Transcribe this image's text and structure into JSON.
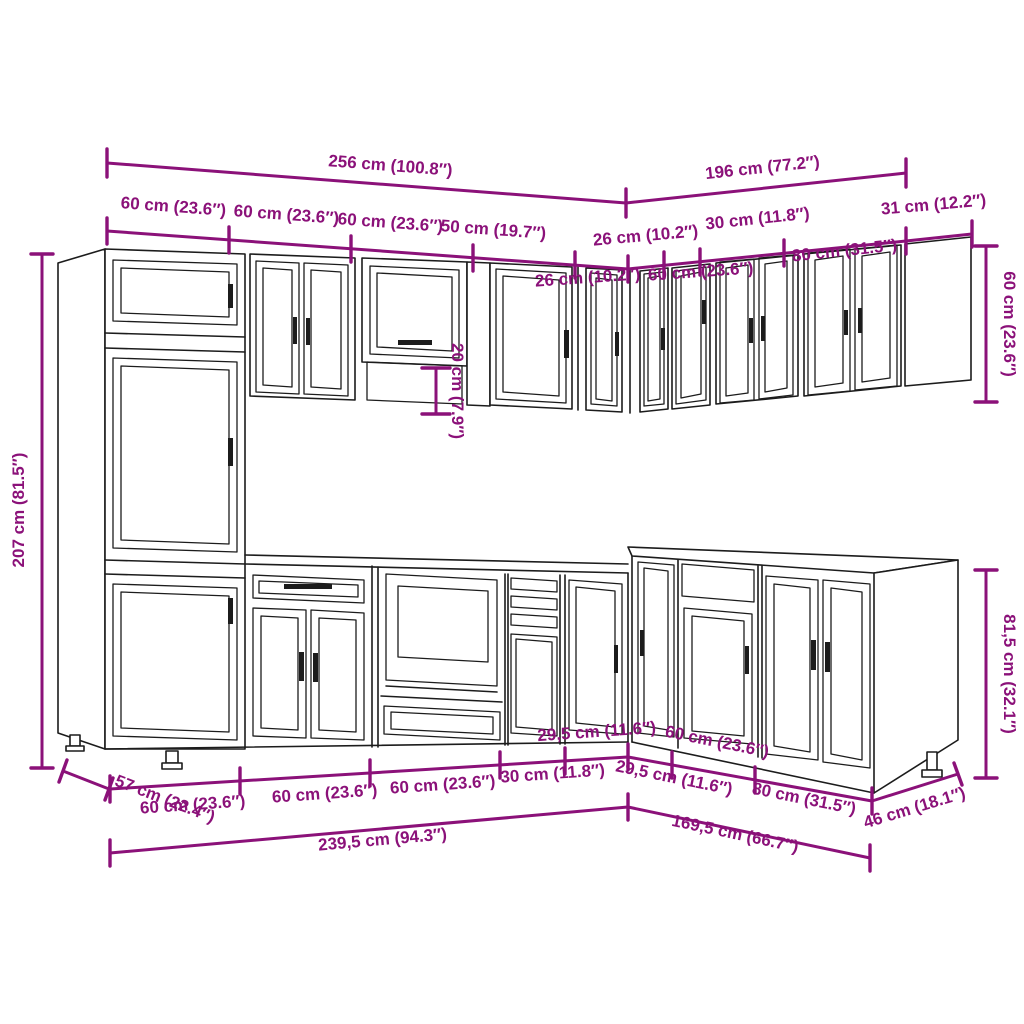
{
  "title": "L-shaped kitchen cabinet set dimension diagram",
  "colors": {
    "dimension": "#8B1179",
    "outline": "#1c1c1c",
    "background": "#ffffff"
  },
  "labels": {
    "top_total_left": "256 cm (100.8″)",
    "top_total_right": "196 cm (77.2″)",
    "wall_left": [
      "60 cm (23.6″)",
      "60 cm (23.6″)",
      "60 cm (23.6″)",
      "50 cm (19.7″)",
      "26 cm (10.2″)"
    ],
    "wall_right": [
      "26 cm (10.2″)",
      "30 cm (11.8″)",
      "60 cm (23.6″)",
      "80 cm (31.5″)"
    ],
    "wall_end_depth": "31 cm (12.2″)",
    "wall_height": "60 cm (23.6″)",
    "tall_height": "207 cm (81.5″)",
    "niche_height": "20 cm (7.9″)",
    "base_height": "81,5 cm (32.1″)",
    "base_depth_left": "57 cm (22.4″)",
    "base_left": [
      "60 cm (23.6″)",
      "60 cm (23.6″)",
      "60 cm (23.6″)",
      "30 cm (11.8″)",
      "29,5 cm (11.6″)"
    ],
    "base_right": [
      "29,5 cm (11.6″)",
      "60 cm (23.6″)",
      "80 cm (31.5″)"
    ],
    "base_depth_right": "46 cm (18.1″)",
    "bottom_total_left": "239,5 cm (94.3″)",
    "bottom_total_right": "169,5 cm (66.7″)"
  }
}
